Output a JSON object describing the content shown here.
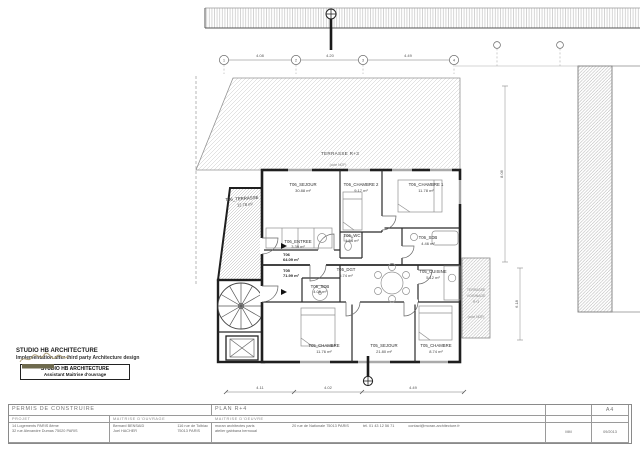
{
  "drawing": {
    "rooms": [
      {
        "name": "T06_TERRASSE",
        "area": "12.78 m²"
      },
      {
        "name": "T06_SEJOUR",
        "area": "30.88 m²"
      },
      {
        "name": "T06_CHAMBRE 2",
        "area": "9.17 m²"
      },
      {
        "name": "T06_CHAMBRE 1",
        "area": "11.78 m²"
      },
      {
        "name": "T06_ENTREE",
        "area": "3.39 m²"
      },
      {
        "name": "T06_WC",
        "area": "1.54 m²"
      },
      {
        "name": "T06_SDB",
        "area": "4.46 m²"
      },
      {
        "name": "T05_DGT",
        "area": "5.74 m²"
      },
      {
        "name": "T05_CUISINE",
        "area": "5.12 m²"
      },
      {
        "name": "T05_SDB",
        "area": "4.05 m²"
      },
      {
        "name": "T05_CHAMBRE",
        "area": "11.76 m²"
      },
      {
        "name": "T05_SEJOUR",
        "area": "21.80 m²"
      },
      {
        "name": "T05_CHAMBRE",
        "area": "8.74 m²"
      }
    ],
    "unit_tags": [
      {
        "label": "T06",
        "area": "64.09 m²"
      },
      {
        "label": "T05",
        "area": "71.99 m²"
      }
    ],
    "zones": {
      "terrasse_r3": "TERRASSE R+3",
      "terrasse_r3_sub": "(cote NGF)",
      "voisinage_l1": "TERRASSE",
      "voisinage_l2": "VOISINAGE",
      "voisinage_l3": "R+3",
      "voisinage_sub": "(cote NGF)"
    },
    "grid": {
      "bubbles": [
        "1",
        "2",
        "3",
        "4"
      ],
      "top_dims": [
        "4.08",
        "4.20",
        "4.49"
      ],
      "bottom_dims": [
        "4.11",
        "4.02",
        "4.49"
      ],
      "right_dim_1": "8.06",
      "right_dim_2": "6.18"
    }
  },
  "annotations": {
    "l1": "STUDIO HB ARCHITECTURE",
    "l2": "Implementation after third party Architecture design",
    "box_l1": "STUDIO HB ARCHITECTURE",
    "box_l2": "Assistant Maitrise d'ouvrage"
  },
  "titleblock": {
    "permit": "PERMIS DE CONSTRUIRE",
    "plan": "PLAN R+4",
    "format": "A4",
    "projet_label": "PROJET",
    "projet_l1": "14 Logements PARIS 8ème",
    "projet_l2": "32 rue Alexandre Dumas 75020 PARIS",
    "mo_label": "MAITRISE D'OUVRAGE",
    "mo_l1": "Bernard BENSAID",
    "mo_l2": "Joel HACHER",
    "mo_addr1": "116 rue de Tolbiac",
    "mo_addr2": "75013 PARIS",
    "moe_label": "MAITRISE D'OEUVRE",
    "moe_l1": "moran architectes paris",
    "moe_l2": "atelier gabbana bernoual",
    "moe_addr": "20 rue de Nationale 75013 PARIS",
    "moe_tel": "tél. 01 43 12 56 71",
    "moe_mail": "contact@moran-architecture.fr",
    "ref": "MM",
    "date": "09/2013"
  }
}
